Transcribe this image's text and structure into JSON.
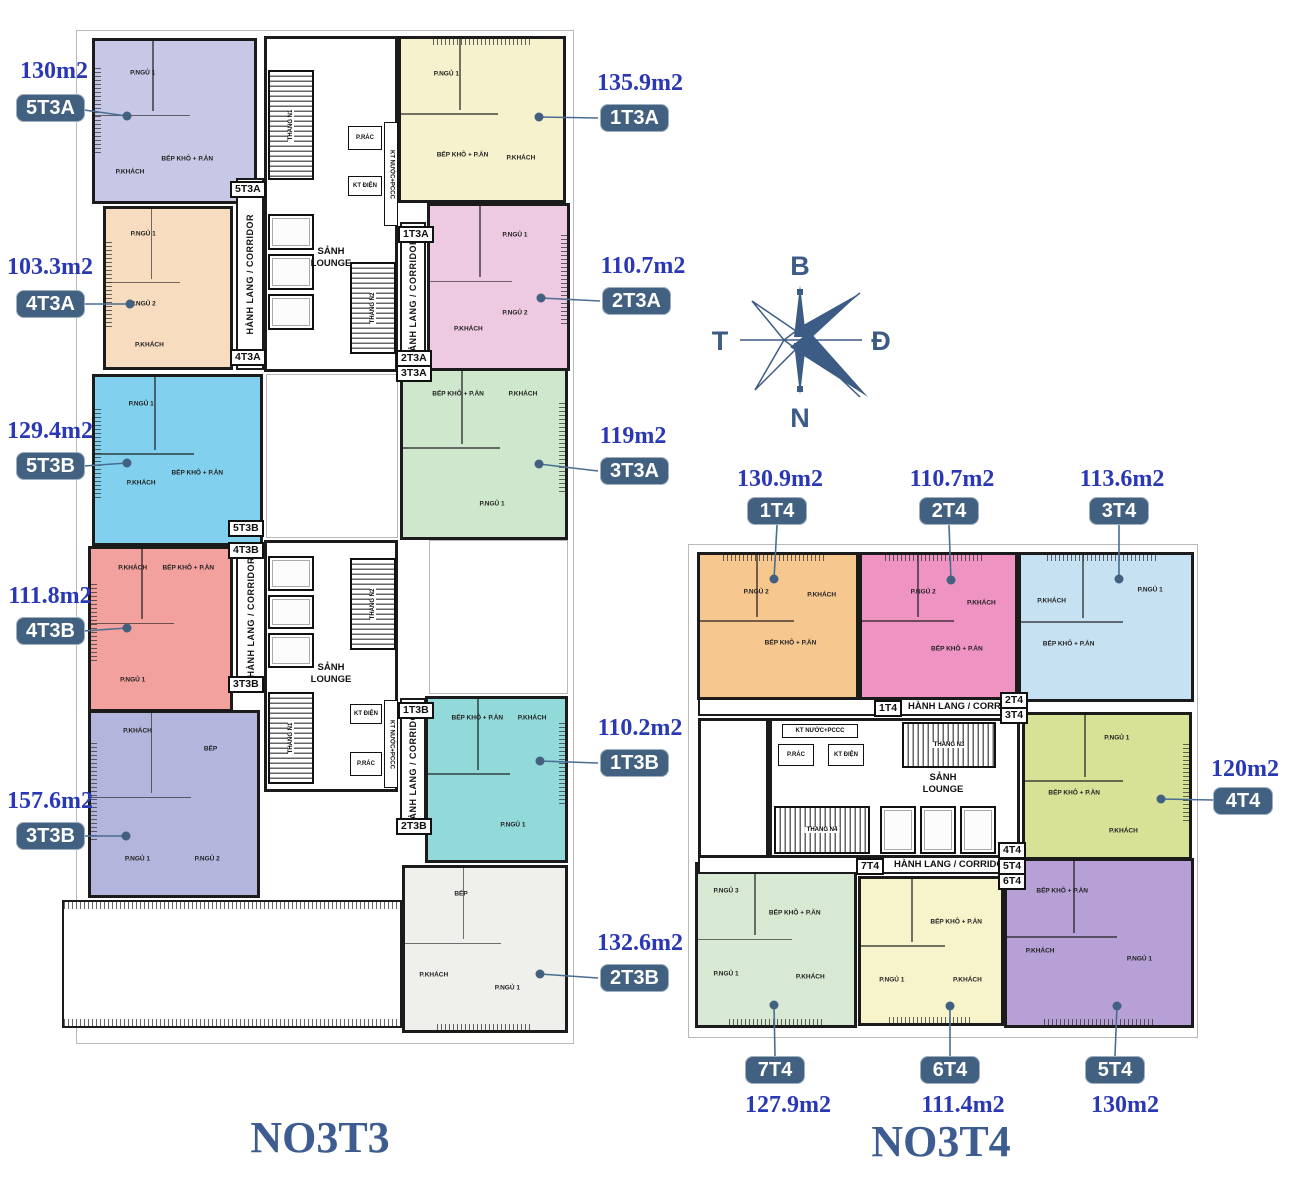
{
  "compass": {
    "north": "B",
    "east": "Đ",
    "south": "N",
    "west": "T"
  },
  "colors": {
    "accent": "#2a38b4",
    "badge": "#42607f",
    "title": "#3d5c90",
    "compass": "#3d5c85",
    "u5t3a": "#c7c8e6",
    "u1t3a": "#f6f2cd",
    "u4t3a": "#f8dcc0",
    "u2t3a": "#eec9e2",
    "u5t3b": "#80d0ee",
    "u3t3a": "#cfe7cc",
    "u4t3b": "#f2a19e",
    "u1t3b": "#92d9da",
    "u3t3b": "#b3b5dd",
    "u2t3b": "#efefec",
    "u1t4": "#f6c890",
    "u2t4": "#ef93c3",
    "u3t4": "#c6e1f2",
    "u4t4": "#d7e296",
    "u5t4": "#b6a0d6",
    "u6t4": "#f7f3cb",
    "u7t4": "#d7e8d3"
  },
  "core": {
    "lounge": "SẢNH LOUNGE",
    "corridor": "HÀNH LANG / CORRIDOR",
    "stair_n1": "THANG N1",
    "stair_n2": "THANG N2",
    "stair_n3": "THANG N3",
    "stair_n4": "THANG N4",
    "trash": "P.RÁC",
    "electrical": "KT ĐIỆN",
    "water": "KT NƯỚC+PCCC"
  },
  "rooms": {
    "bed1": "P.NGỦ 1",
    "bed2": "P.NGỦ 2",
    "bed3": "P.NGỦ 3",
    "living": "P.KHÁCH",
    "kitchen": "BẾP KHÔ + P.ĂN",
    "kitchen_small": "BẾP",
    "wc": "WC"
  },
  "no3t3": {
    "name": "NO3T3",
    "units": [
      {
        "code": "5T3A",
        "area": "130m2"
      },
      {
        "code": "1T3A",
        "area": "135.9m2"
      },
      {
        "code": "4T3A",
        "area": "103.3m2"
      },
      {
        "code": "2T3A",
        "area": "110.7m2"
      },
      {
        "code": "5T3B",
        "area": "129.4m2"
      },
      {
        "code": "3T3A",
        "area": "119m2"
      },
      {
        "code": "4T3B",
        "area": "111.8m2"
      },
      {
        "code": "1T3B",
        "area": "110.2m2"
      },
      {
        "code": "3T3B",
        "area": "157.6m2"
      },
      {
        "code": "2T3B",
        "area": "132.6m2"
      }
    ]
  },
  "no3t4": {
    "name": "NO3T4",
    "units": [
      {
        "code": "1T4",
        "area": "130.9m2"
      },
      {
        "code": "2T4",
        "area": "110.7m2"
      },
      {
        "code": "3T4",
        "area": "113.6m2"
      },
      {
        "code": "4T4",
        "area": "120m2"
      },
      {
        "code": "5T4",
        "area": "130m2"
      },
      {
        "code": "6T4",
        "area": "111.4m2"
      },
      {
        "code": "7T4",
        "area": "127.9m2"
      }
    ]
  }
}
